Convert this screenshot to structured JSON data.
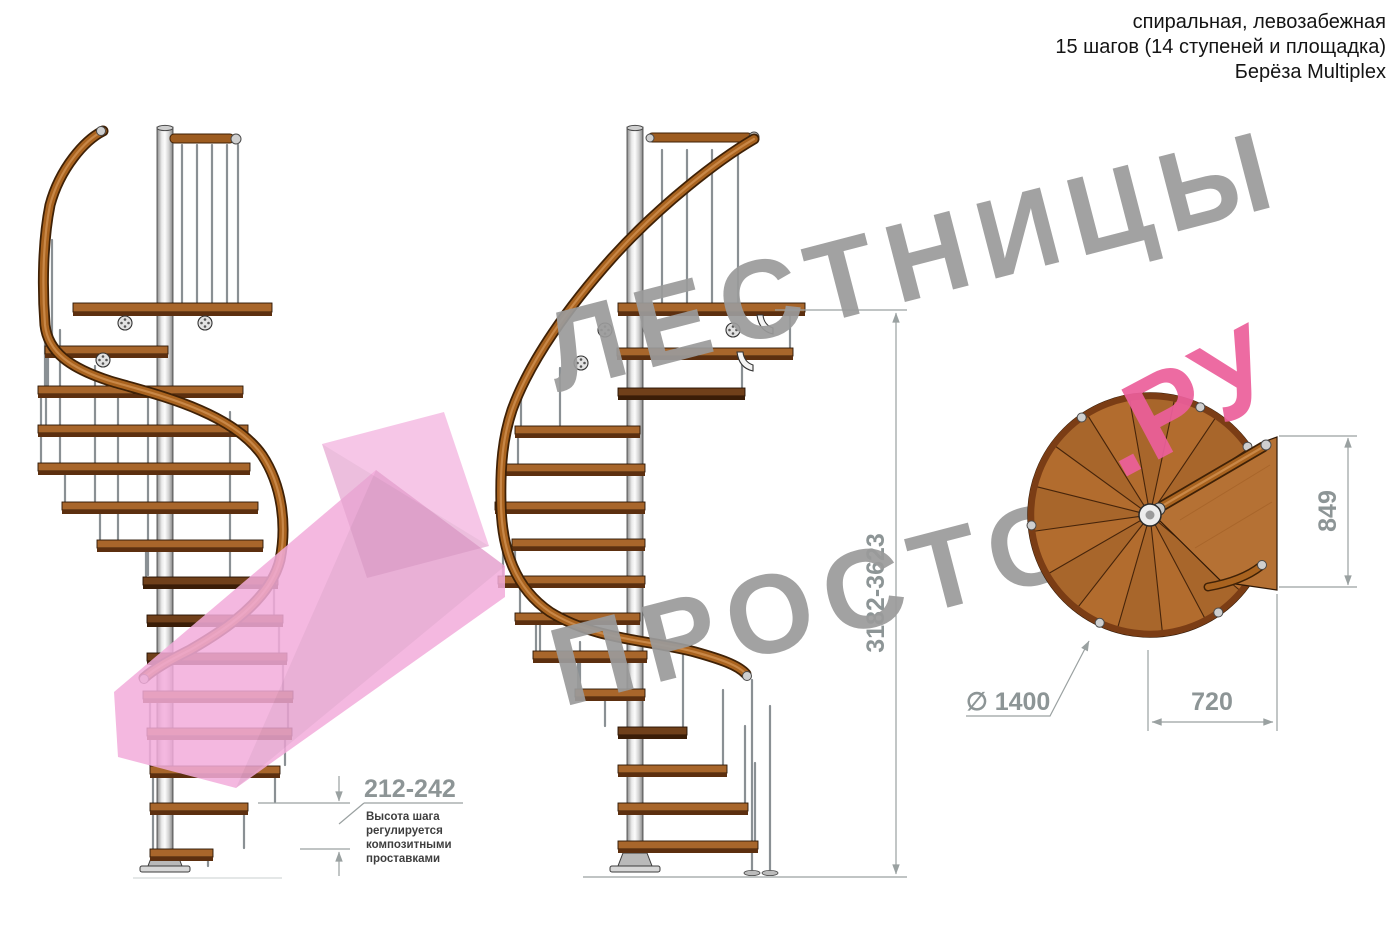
{
  "title_block": {
    "line1": "спиральная, левозабежная",
    "line2": "15 шагов (14 ступеней и площадка)",
    "line3": "Берёза Multiplex"
  },
  "watermark": {
    "word_top": "ЛЕСТНИЦЫ",
    "word_bottom": "ПРОСТО",
    "suffix": ".РУ"
  },
  "dimensions": {
    "total_height": "3182-3623",
    "step_height": "212-242",
    "step_height_note": [
      "Высота шага",
      "регулируется",
      "композитными",
      "проставками"
    ],
    "platform_depth": "849",
    "platform_width": "720",
    "diameter": "∅ 1400"
  },
  "colors": {
    "wood": "#a8662b",
    "wood_dark": "#70401a",
    "handrail": "#a9631f",
    "metal": "#d9d9d9",
    "dimension_gray": "#8d9596",
    "watermark_gray": "#9b9b9b",
    "watermark_pink": "#ec5f9b",
    "arrow_pink": "#f2abdb"
  }
}
